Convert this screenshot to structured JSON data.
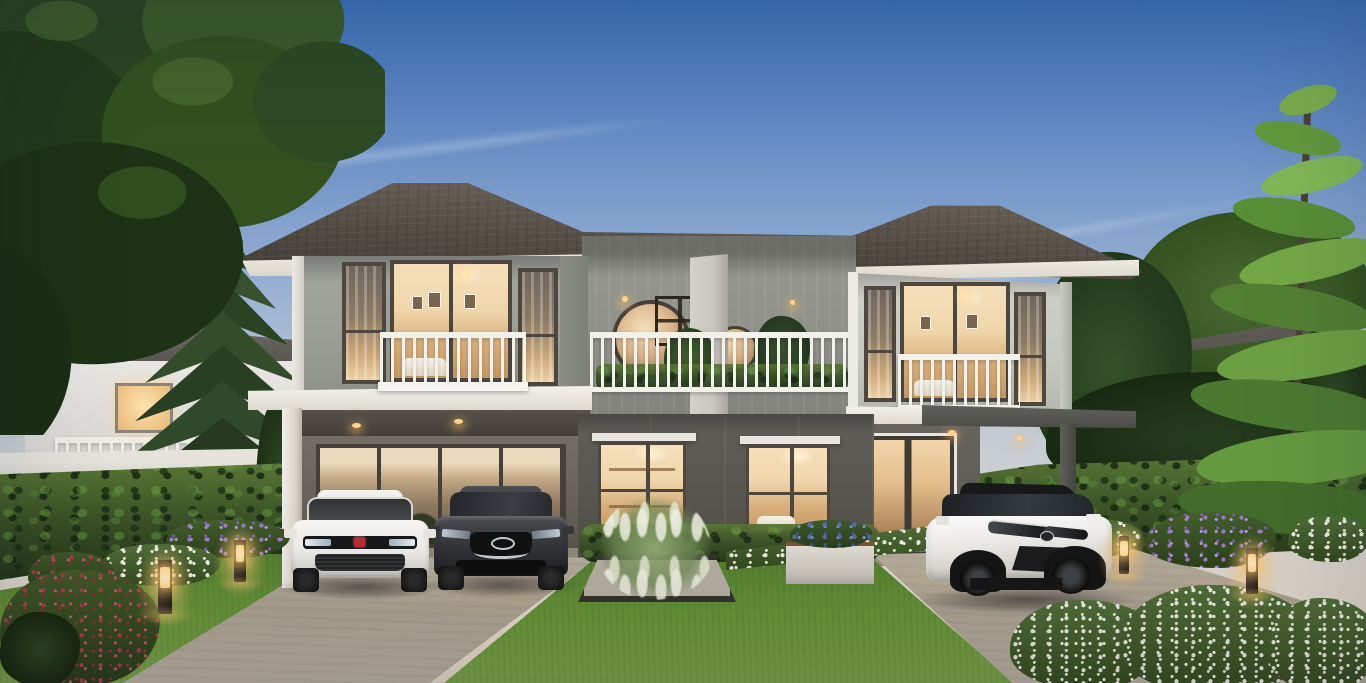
{
  "scene": {
    "description": "Dusk 3D architectural rendering of a modern two-storey duplex (twin) house with glowing interiors, white balcony railings, two carports with a white hatchback, a dark grey sedan and a white compact SUV, landscaped garden with hedges, flower borders and lit bollard lamps",
    "time_of_day": "dusk",
    "palette": {
      "sky_top": "#3c72ba",
      "sky_mid": "#8ba7cf",
      "sky_low": "#d7d5d1",
      "sky_horizon": "#e8dfd0",
      "roof_dark": "#3f3934",
      "roof_light": "#6d6459",
      "fascia_white": "#efece4",
      "wall_upper_left": "#9a9e96",
      "wall_upper_right": "#c6c9c0",
      "wall_center": "#8f918a",
      "wall_lower": "#5e5c56",
      "divider_wall": "#d3d1ca",
      "window_frame": "#4e4740",
      "window_glow": "#f5dfba",
      "glow_deep": "#c89a63",
      "railing_white": "#f2f1ea",
      "hedge_dark": "#22351a",
      "hedge_mid": "#3c5527",
      "hedge_light": "#5a7836",
      "lawn_dark": "#4f7a2e",
      "lawn_light": "#7ca94a",
      "driveway": "#aca495",
      "driveway_light": "#beb6a7",
      "lamp_glow": "#ffd78e",
      "car_white": "#f0efec",
      "car_dark": "#313439",
      "suv_black_roof": "#16181a",
      "flower_red": "#a83d4b",
      "flower_purple": "#9b7fc2",
      "flower_white": "#edefe3",
      "flower_blue": "#5a6eb4",
      "bg_house_wall": "#e2e4e3",
      "bg_house_roof": "#57544e",
      "pine_green": "#31482a",
      "conifer_green": "#74a848",
      "tree_canopy": "#2b4520"
    },
    "objects": [
      {
        "name": "dusk-sky-with-cirrus-clouds"
      },
      {
        "name": "duplex-house",
        "detail": "grey two-tone facade, hip tile roofs, warm lit windows"
      },
      {
        "name": "left-unit-carport",
        "detail": "white frame, two cars parked"
      },
      {
        "name": "right-unit-carport",
        "detail": "dark frame, one SUV parked"
      },
      {
        "name": "white-hatchback-car",
        "detail": "red brand badge, front view"
      },
      {
        "name": "dark-grey-sedan-car",
        "detail": "chrome wing grille, front view"
      },
      {
        "name": "white-compact-suv",
        "detail": "black roof and wheel arches, three-quarter view"
      },
      {
        "name": "central-roof-terrace",
        "detail": "white railing, two round stair windows, divider wall"
      },
      {
        "name": "norfolk-pine-tree"
      },
      {
        "name": "broadleaf-tree-canopy-top-left"
      },
      {
        "name": "bright-conifer-tree-right"
      },
      {
        "name": "neighbour-house-left"
      },
      {
        "name": "neighbour-house-right"
      },
      {
        "name": "perimeter-wall-and-hedges"
      },
      {
        "name": "flower-borders",
        "colors": [
          "red",
          "white",
          "purple",
          "blue"
        ]
      },
      {
        "name": "garden-bollard-lamps",
        "count": 4
      },
      {
        "name": "concrete-driveways"
      },
      {
        "name": "lawns-and-square-planting-bed"
      },
      {
        "name": "white-flowering-shrubs-bottom-right"
      }
    ]
  }
}
